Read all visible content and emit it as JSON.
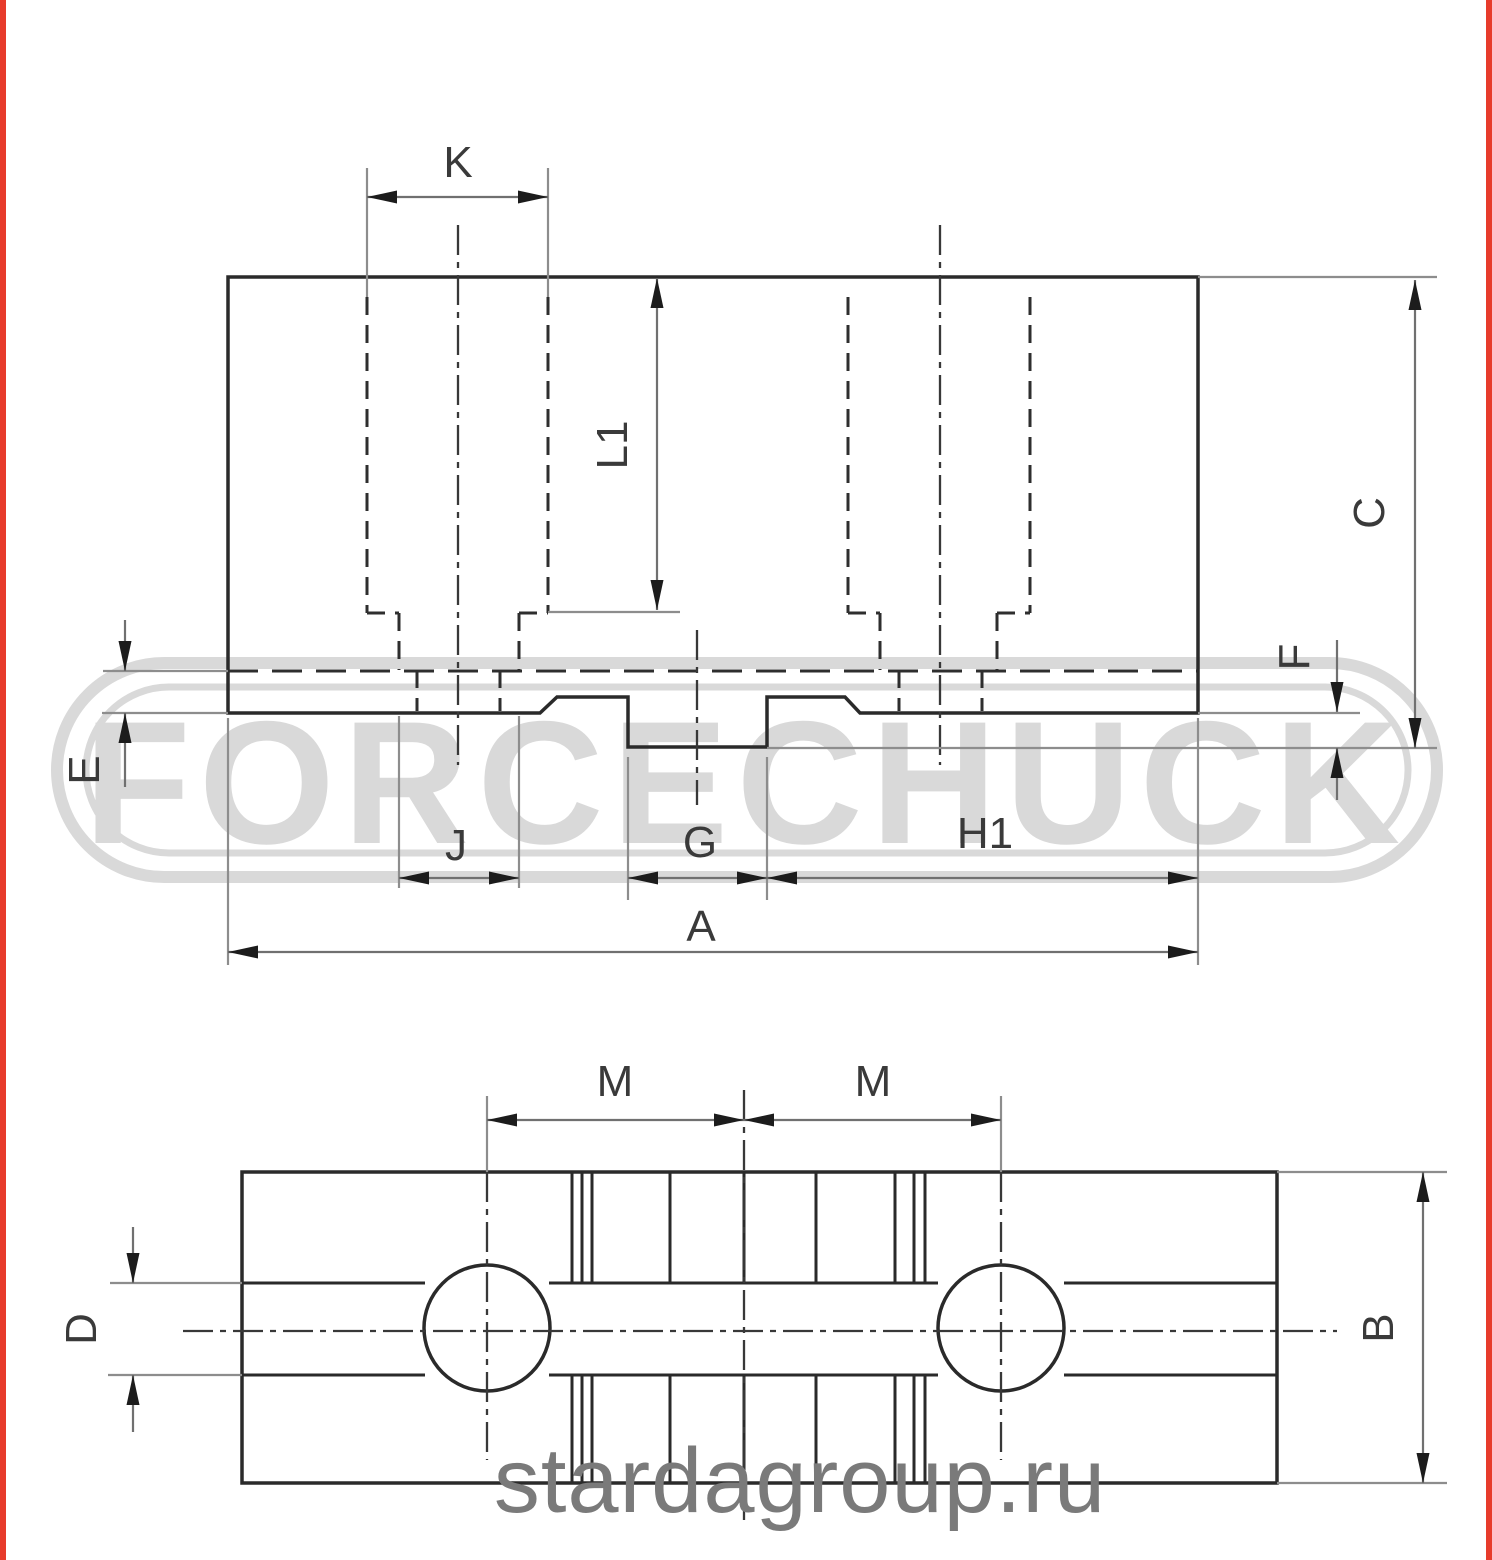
{
  "colors": {
    "accent-red": "#e73b2b",
    "line-dark": "#2a2a2a",
    "line-ext": "#8d8d8d",
    "line-dim": "#707070",
    "label": "#3a3a3a",
    "watermark": "#d9d9d9",
    "site": "#7a7a7a",
    "bg": "#ffffff"
  },
  "watermark": {
    "brand": "FORCECHUCK",
    "site": "stardagroup.ru"
  },
  "top_view": {
    "labels": {
      "k": "K",
      "l1": "L1",
      "c": "C",
      "e": "E",
      "f": "F",
      "j": "J",
      "g": "G",
      "h1": "H1",
      "a": "A"
    }
  },
  "bottom_view": {
    "labels": {
      "m_left": "M",
      "m_right": "M",
      "d": "D",
      "b": "B"
    }
  }
}
